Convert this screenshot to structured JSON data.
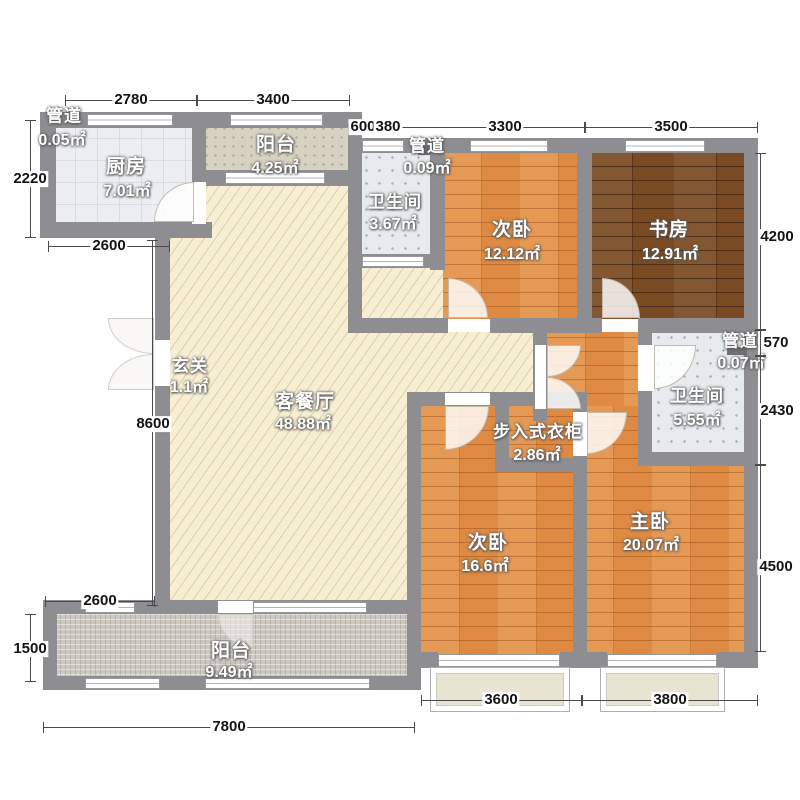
{
  "plan_title": "三室两厅户型图",
  "rooms": [
    {
      "id": "duct-top-left",
      "name": "管道",
      "area": "0.05㎡"
    },
    {
      "id": "kitchen",
      "name": "厨房",
      "area": "7.01㎡"
    },
    {
      "id": "balcony-top",
      "name": "阳台",
      "area": "4.25㎡"
    },
    {
      "id": "bathroom-top",
      "name": "卫生间",
      "area": "3.67㎡"
    },
    {
      "id": "duct-top",
      "name": "管道",
      "area": "0.09㎡"
    },
    {
      "id": "bedroom2-top",
      "name": "次卧",
      "area": "12.12㎡"
    },
    {
      "id": "study",
      "name": "书房",
      "area": "12.91㎡"
    },
    {
      "id": "entry",
      "name": "玄关",
      "area": "1.1㎡"
    },
    {
      "id": "living-dining",
      "name": "客餐厅",
      "area": "48.88㎡"
    },
    {
      "id": "walkin-closet",
      "name": "步入式衣柜",
      "area": "2.86㎡"
    },
    {
      "id": "bathroom-right",
      "name": "卫生间",
      "area": "5.55㎡"
    },
    {
      "id": "duct-right",
      "name": "管道",
      "area": "0.07㎡"
    },
    {
      "id": "bedroom2-bottom",
      "name": "次卧",
      "area": "16.6㎡"
    },
    {
      "id": "master-bedroom",
      "name": "主卧",
      "area": "20.07㎡"
    },
    {
      "id": "balcony-bottom",
      "name": "阳台",
      "area": "9.49㎡"
    }
  ],
  "dims": {
    "top1": [
      "2780",
      "3400"
    ],
    "top2": [
      "600",
      "380",
      "3300",
      "3500"
    ],
    "left": [
      "2220",
      "8600",
      "1500"
    ],
    "right": [
      "4200",
      "570",
      "2430",
      "4500"
    ],
    "inner": [
      "2600",
      "2600"
    ],
    "bottom": [
      "3600",
      "3800",
      "7800"
    ]
  },
  "colors": {
    "wall": "#8d8d92",
    "wood": "#de8a42",
    "wood_dark": "#7a4a22",
    "living": "#f7efd4",
    "bath_tile": "#e7ebed",
    "balcony_tile": "#ccc8bf",
    "dimension_text": "#141414"
  }
}
